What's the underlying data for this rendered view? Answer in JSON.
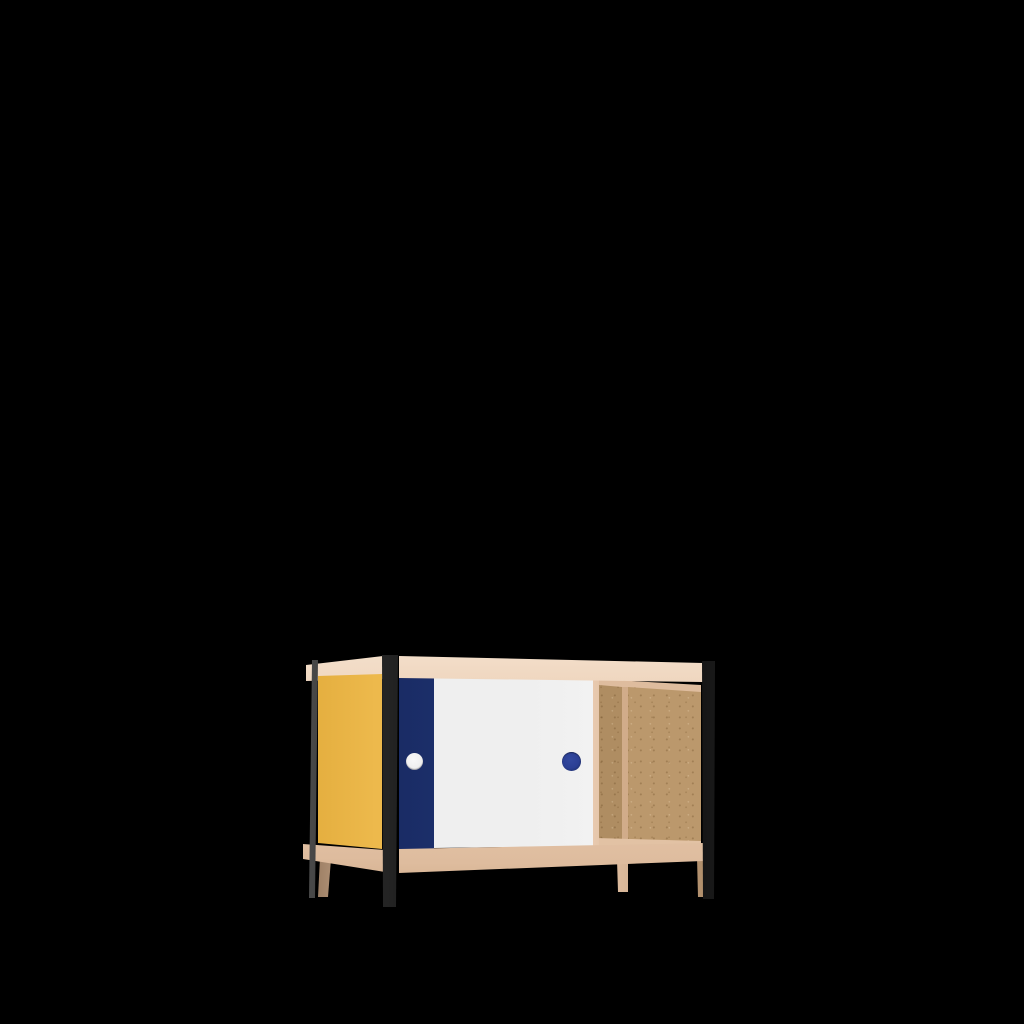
{
  "scene": {
    "canvas_width": 1024,
    "canvas_height": 1024,
    "background_color": "#000000",
    "subject": "product render of a low sideboard cabinet with sliding doors, no text"
  },
  "object": {
    "name": "sideboard-cabinet",
    "parts": [
      {
        "name": "birch-frame-top-rail",
        "color": "#E8C9AE"
      },
      {
        "name": "birch-frame-bottom-rail",
        "color": "#E8C9AE"
      },
      {
        "name": "yellow-side-panel",
        "color": "#EDB94C"
      },
      {
        "name": "navy-sliding-door",
        "color": "#1C2F6B"
      },
      {
        "name": "white-sliding-door",
        "color": "#EFEFEF"
      },
      {
        "name": "white-round-handle",
        "color": "#F4F4F4"
      },
      {
        "name": "blue-round-handle",
        "color": "#2B3F94"
      },
      {
        "name": "mdf-open-compartment",
        "color": "#BB986C"
      },
      {
        "name": "plywood-divider-edge",
        "color": "#E8C9AE"
      },
      {
        "name": "black-steel-posts",
        "color": "#101010"
      },
      {
        "name": "wooden-feet",
        "color": "#E2C2A4"
      }
    ]
  },
  "palette": {
    "background": "#000000",
    "wood_hi": "#F4E0CC",
    "wood": "#E8C9AE",
    "wood_mid": "#DEBC9E",
    "wood_shade": "#CDA884",
    "wood_leg": "#E2C2A4",
    "yellow": "#EDB94C",
    "yellow_deep": "#E2AC3C",
    "navy": "#1C2F6B",
    "navy_deep": "#152558",
    "blue_handle": "#2B3F94",
    "white_door": "#EFEFEF",
    "white_hi": "#F8F8F8",
    "white_shade": "#D9D9D9",
    "mdf": "#BB986C",
    "mdf_dark": "#AF8D62",
    "steel_black": "#101010",
    "steel_hi": "#4E4E4E"
  }
}
